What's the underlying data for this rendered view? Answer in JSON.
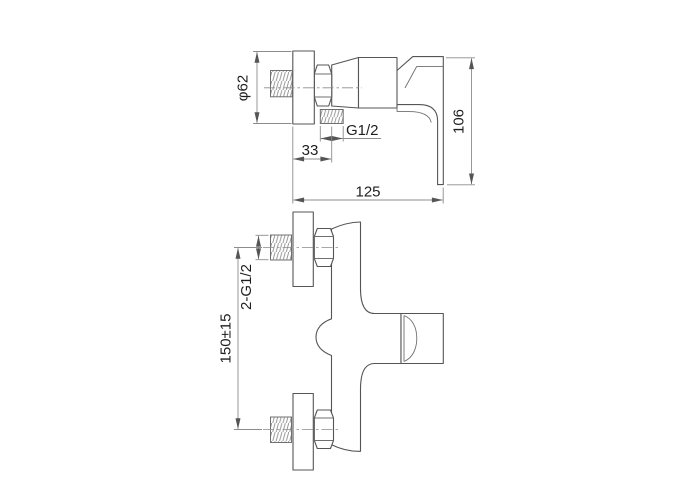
{
  "drawing": {
    "labels": {
      "flange_diameter": "φ62",
      "outlet_thread": "G1/2",
      "outlet_offset": "33",
      "overall_depth": "125",
      "handle_height": "106",
      "inlet_threads": "2-G1/2",
      "inlet_spacing": "150±15"
    },
    "colors": {
      "background": "#ffffff",
      "outline": "#555555",
      "dimension": "#8c8c8c",
      "hatch": "#909090",
      "text": "#1e1e1e"
    }
  }
}
